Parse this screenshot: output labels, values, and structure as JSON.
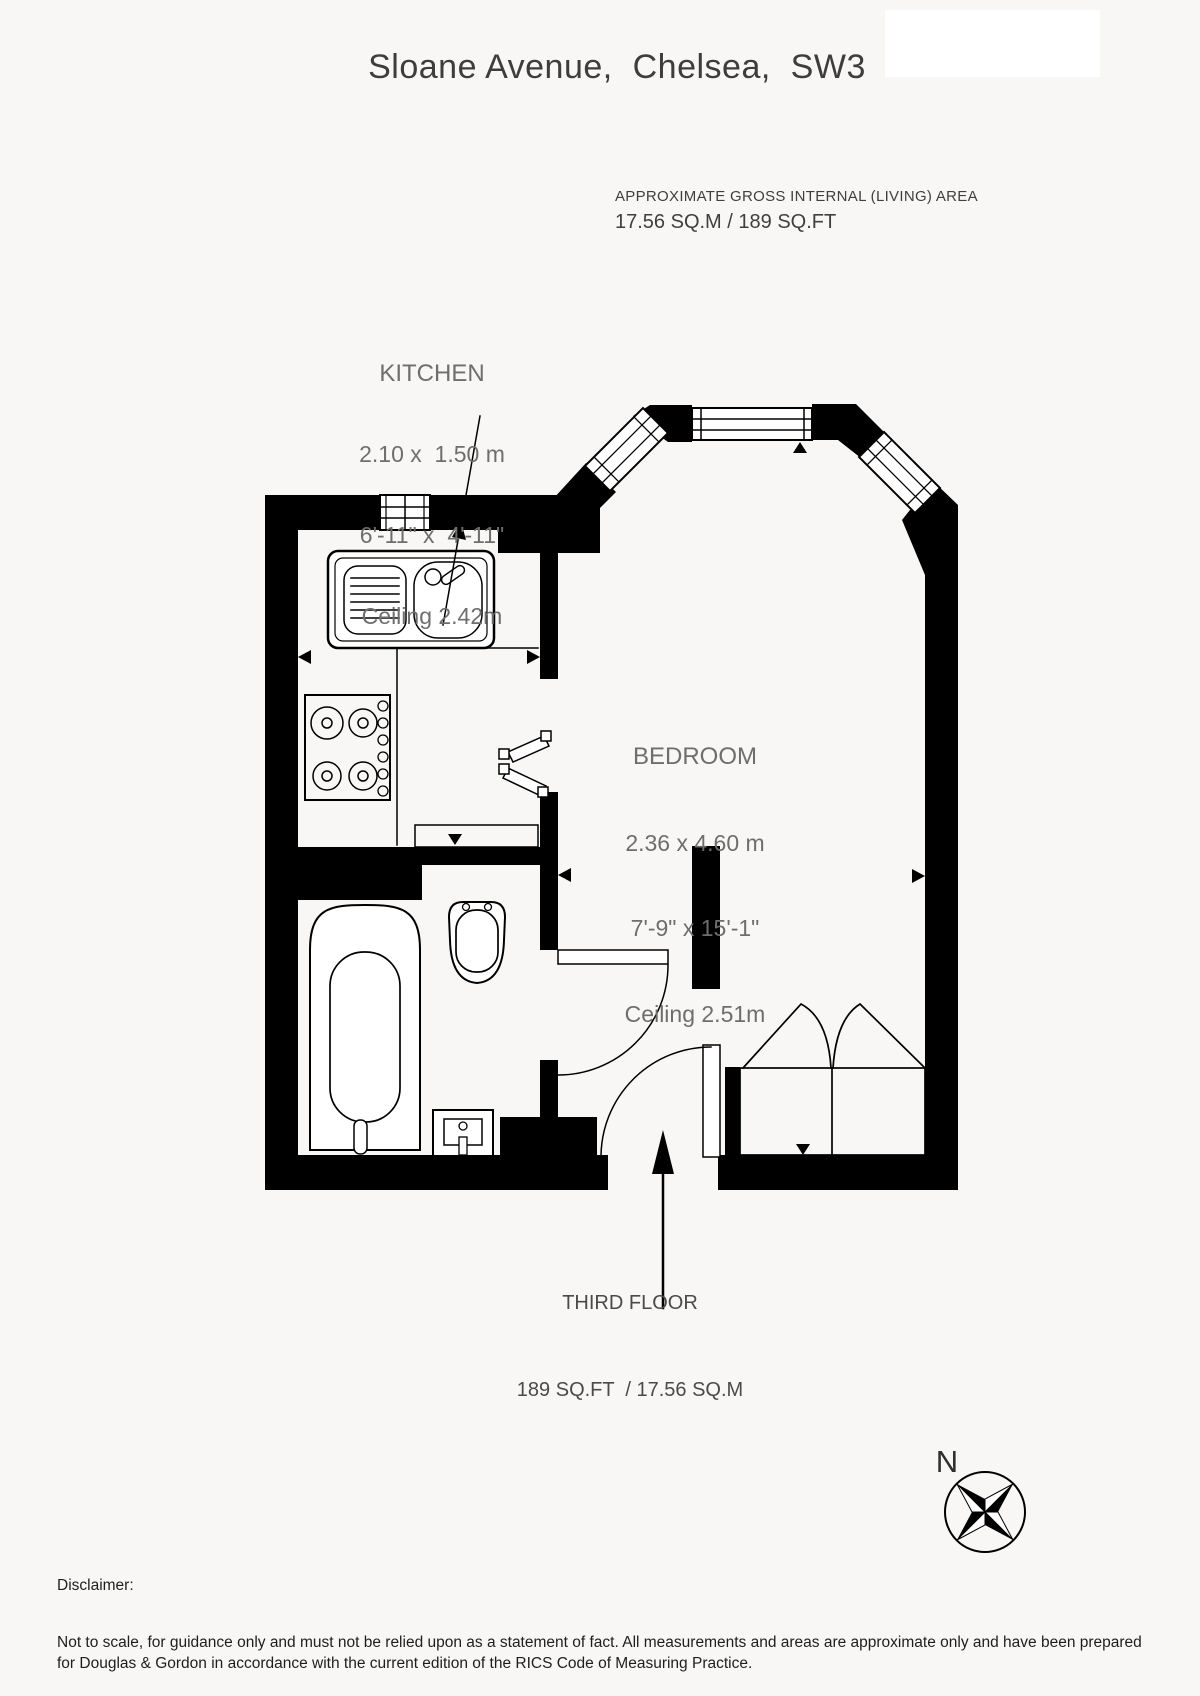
{
  "header": {
    "title": "Sloane Avenue,  Chelsea,  SW3",
    "area_label": "APPROXIMATE GROSS INTERNAL (LIVING) AREA",
    "area_value": "17.56 SQ.M / 189 SQ.FT"
  },
  "rooms": [
    {
      "name": "KITCHEN",
      "metric": "2.10 x  1.50 m",
      "imperial": "6'-11\" x  4'-11\"",
      "ceiling": "Ceiling 2.42m"
    },
    {
      "name": "BEDROOM",
      "metric": "2.36 x 4.60 m",
      "imperial": "7'-9\" x 15'-1\"",
      "ceiling": "Ceiling 2.51m"
    }
  ],
  "floor": {
    "line1": "THIRD FLOOR",
    "line2": "189 SQ.FT  / 17.56 SQ.M"
  },
  "compass": {
    "label": "N"
  },
  "disclaimer": {
    "heading": "Disclaimer:",
    "body": "Not to scale, for guidance only and must not be relied upon as a statement of fact. All measurements and areas are approximate only and have been prepared for Douglas & Gordon in accordance with the current edition of the RICS Code of Measuring Practice."
  },
  "colors": {
    "wall": "#000000",
    "room_text": "#6e6e6e",
    "heading_text": "#3d3d3d",
    "background": "#f8f7f5"
  }
}
